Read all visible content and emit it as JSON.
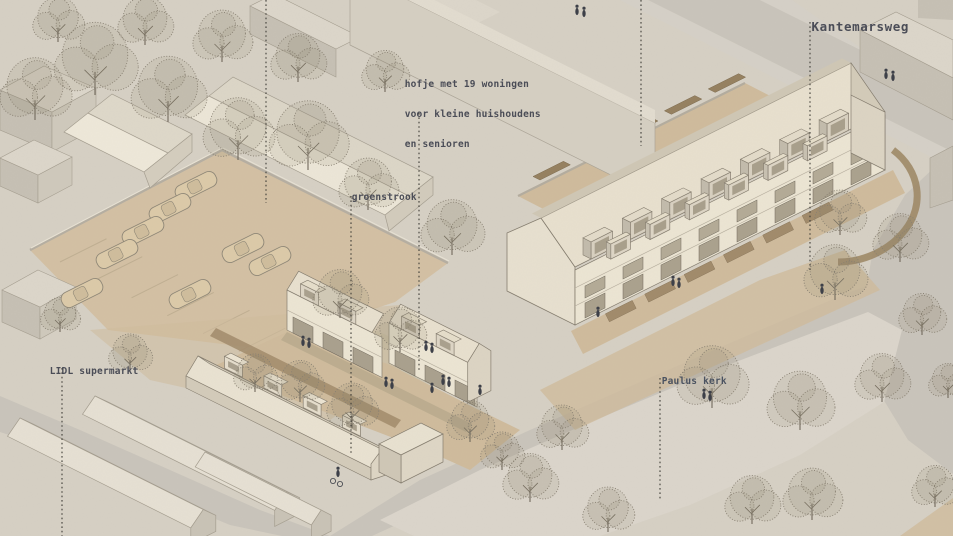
{
  "annotations": {
    "hofje": {
      "line1": "hofje met 19 woningen",
      "line2": "voor kleine huishoudens",
      "line3": "en senioren"
    },
    "groenstrook": {
      "label": "groenstrook"
    },
    "kantemarsweg": {
      "label": "Kantemarsweg"
    },
    "lidl": {
      "label": "LIDL supermarkt"
    },
    "paulus": {
      "label": "Paulus kerk"
    }
  },
  "palette": {
    "paper": "#d6d0c4",
    "road": "#c9c4bb",
    "sidewalk": "#d5d0c7",
    "plaza": "#dbd5cb",
    "path_tan": "#cfbb9c",
    "parking_tan": "#d3c0a3",
    "facade_cream": "#ece5d3",
    "facade_shade": "#dcd4c3",
    "roof_light": "#e8e0ce",
    "roof_dark": "#cfc7b5",
    "window_dark": "#a9a08d",
    "context_top": "#dcd6ca",
    "context_side": "#c6c0b4",
    "hedge": "#a18a6a",
    "tree_stroke": "#877f71",
    "person": "#3a3d46",
    "car_body": "#dccaa8",
    "label_ink": "#4b4d57",
    "leader_line": "#3c3b35"
  }
}
